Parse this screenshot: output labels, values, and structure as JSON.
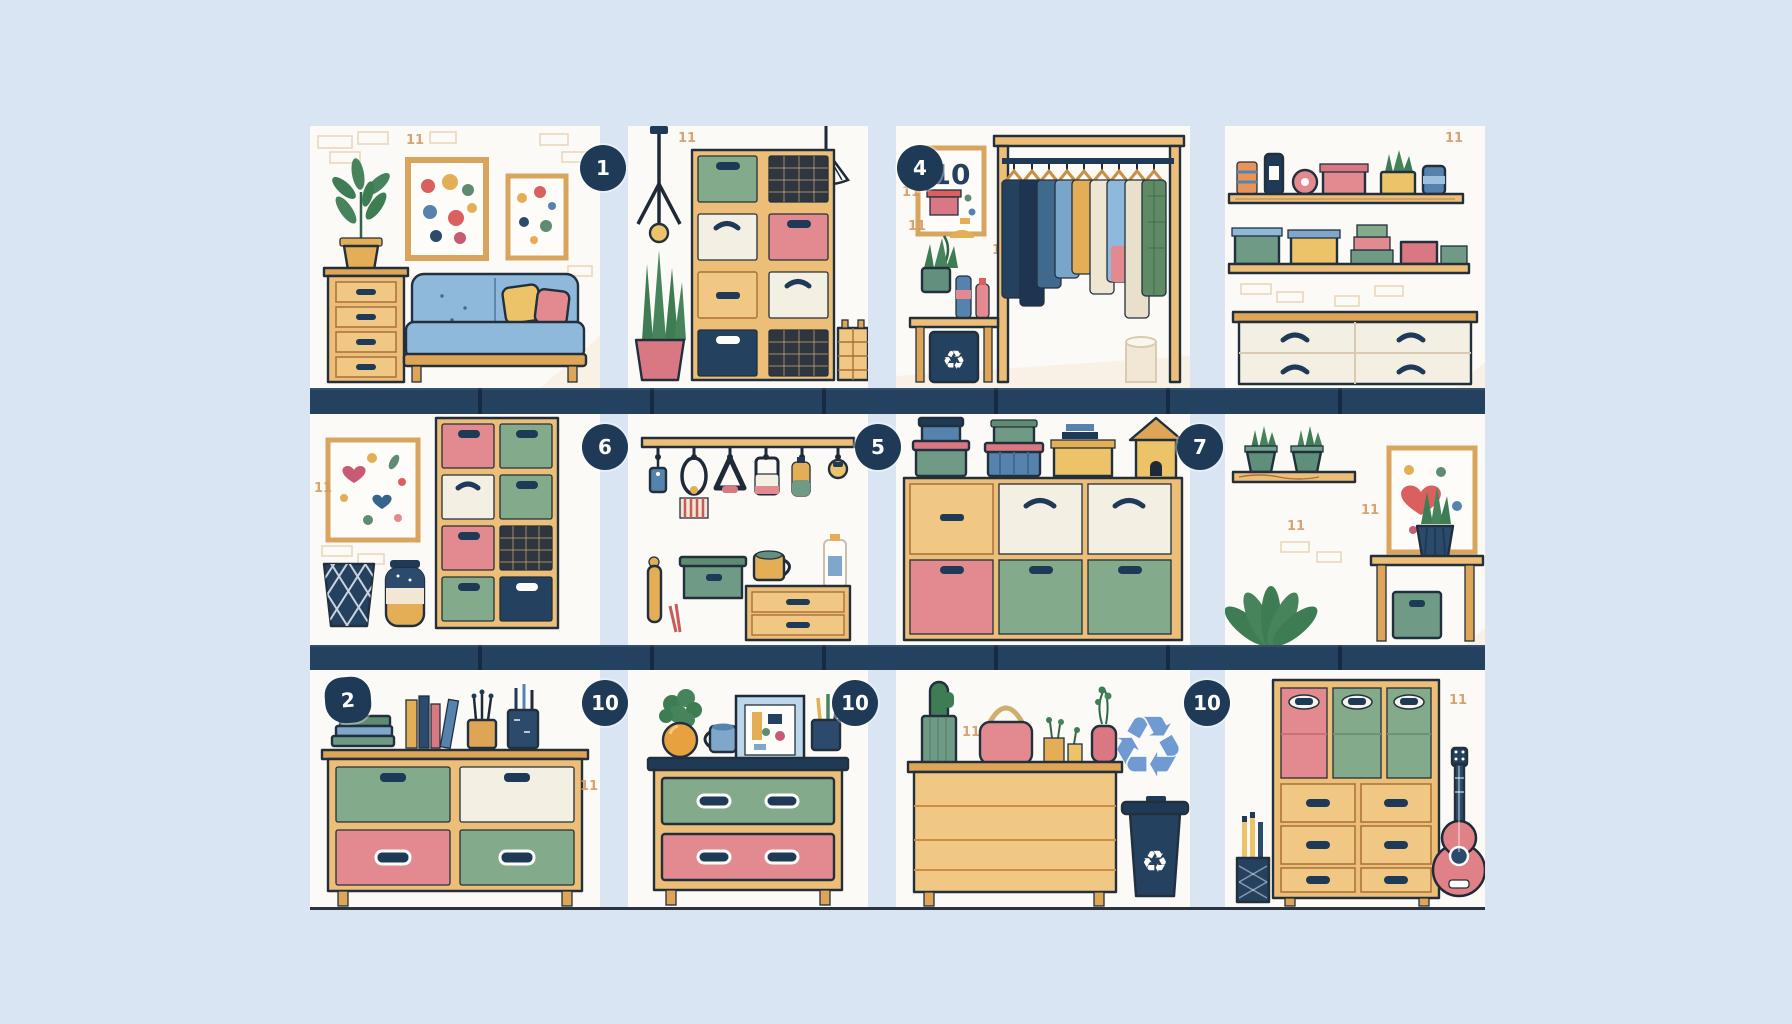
{
  "scene": {
    "type": "illustration",
    "subject": "Home storage and decluttering tips grid",
    "rows": 3,
    "columns": 4
  },
  "badges": [
    {
      "label": "1"
    },
    {
      "label": "4"
    },
    {
      "label": "6"
    },
    {
      "label": "5"
    },
    {
      "label": "7"
    },
    {
      "label": "2"
    },
    {
      "label": "10"
    },
    {
      "label": "10"
    },
    {
      "label": "10"
    }
  ],
  "poster_number": "10",
  "artifact_mark": "11",
  "icons": {
    "recycle": "♻"
  },
  "palette": {
    "background": "#d9e5f2",
    "panel": "#fcfaf6",
    "navy": "#1e3a57",
    "wood": "#ecbe77",
    "wood_dark": "#dfa557",
    "green": "#84aa8c",
    "pink": "#e28a90",
    "cream": "#f4efe3",
    "sofa_blue": "#8fb9da",
    "yellow": "#ecc369",
    "plant_green": "#47845c",
    "recycle_blue": "#6f9bd2"
  },
  "panels": [
    {
      "id": "living-room",
      "items": [
        "potted-plant",
        "drawer-cart",
        "wall-art",
        "wall-art",
        "sofa",
        "pillows"
      ]
    },
    {
      "id": "cube-shelf-lamps",
      "items": [
        "tripod-pendant-lamp",
        "striped-pendant-lamp",
        "cube-storage-bins",
        "snake-plant",
        "woven-basket"
      ]
    },
    {
      "id": "clothing-rack",
      "items": [
        "poster-frame",
        "garment-rack",
        "hangers",
        "side-table",
        "recycle-bin",
        "potted-plant",
        "paper-roll"
      ]
    },
    {
      "id": "wall-shelves-dresser",
      "items": [
        "wall-shelf-jars",
        "wall-shelf-boxes",
        "white-dresser"
      ]
    },
    {
      "id": "art-and-cubes",
      "items": [
        "wall-art",
        "cube-storage-bins",
        "woven-waste-basket",
        "striped-vase"
      ]
    },
    {
      "id": "wall-hooks",
      "items": [
        "hook-rail",
        "hanging-accessories",
        "storage-box",
        "mug",
        "bottle",
        "mini-drawer-chest",
        "rolling-pin"
      ]
    },
    {
      "id": "stacked-containers",
      "items": [
        "lidded-tubs",
        "storage-box",
        "books",
        "birdhouse",
        "cube-storage-bins"
      ]
    },
    {
      "id": "plant-corner",
      "items": [
        "plant-shelf",
        "wall-art",
        "potted-plant",
        "console-table",
        "storage-bin",
        "floor-plant"
      ]
    },
    {
      "id": "stationery-cabinet",
      "items": [
        "book-stack",
        "upright-books",
        "brush-cup",
        "pen-cup",
        "bin-cabinet"
      ]
    },
    {
      "id": "two-drawer-dresser",
      "items": [
        "potted-plant",
        "mug",
        "photo-frame",
        "pen-cup",
        "green-drawer",
        "pink-drawer"
      ]
    },
    {
      "id": "recycle-corner",
      "items": [
        "cactus",
        "handbag",
        "small-pots",
        "vase-plant",
        "plain-dresser",
        "recycle-symbol",
        "wheelie-bin"
      ]
    },
    {
      "id": "tall-cabinet-guitar",
      "items": [
        "pencil-cup",
        "bin-and-drawer-cabinet",
        "guitar"
      ]
    }
  ]
}
